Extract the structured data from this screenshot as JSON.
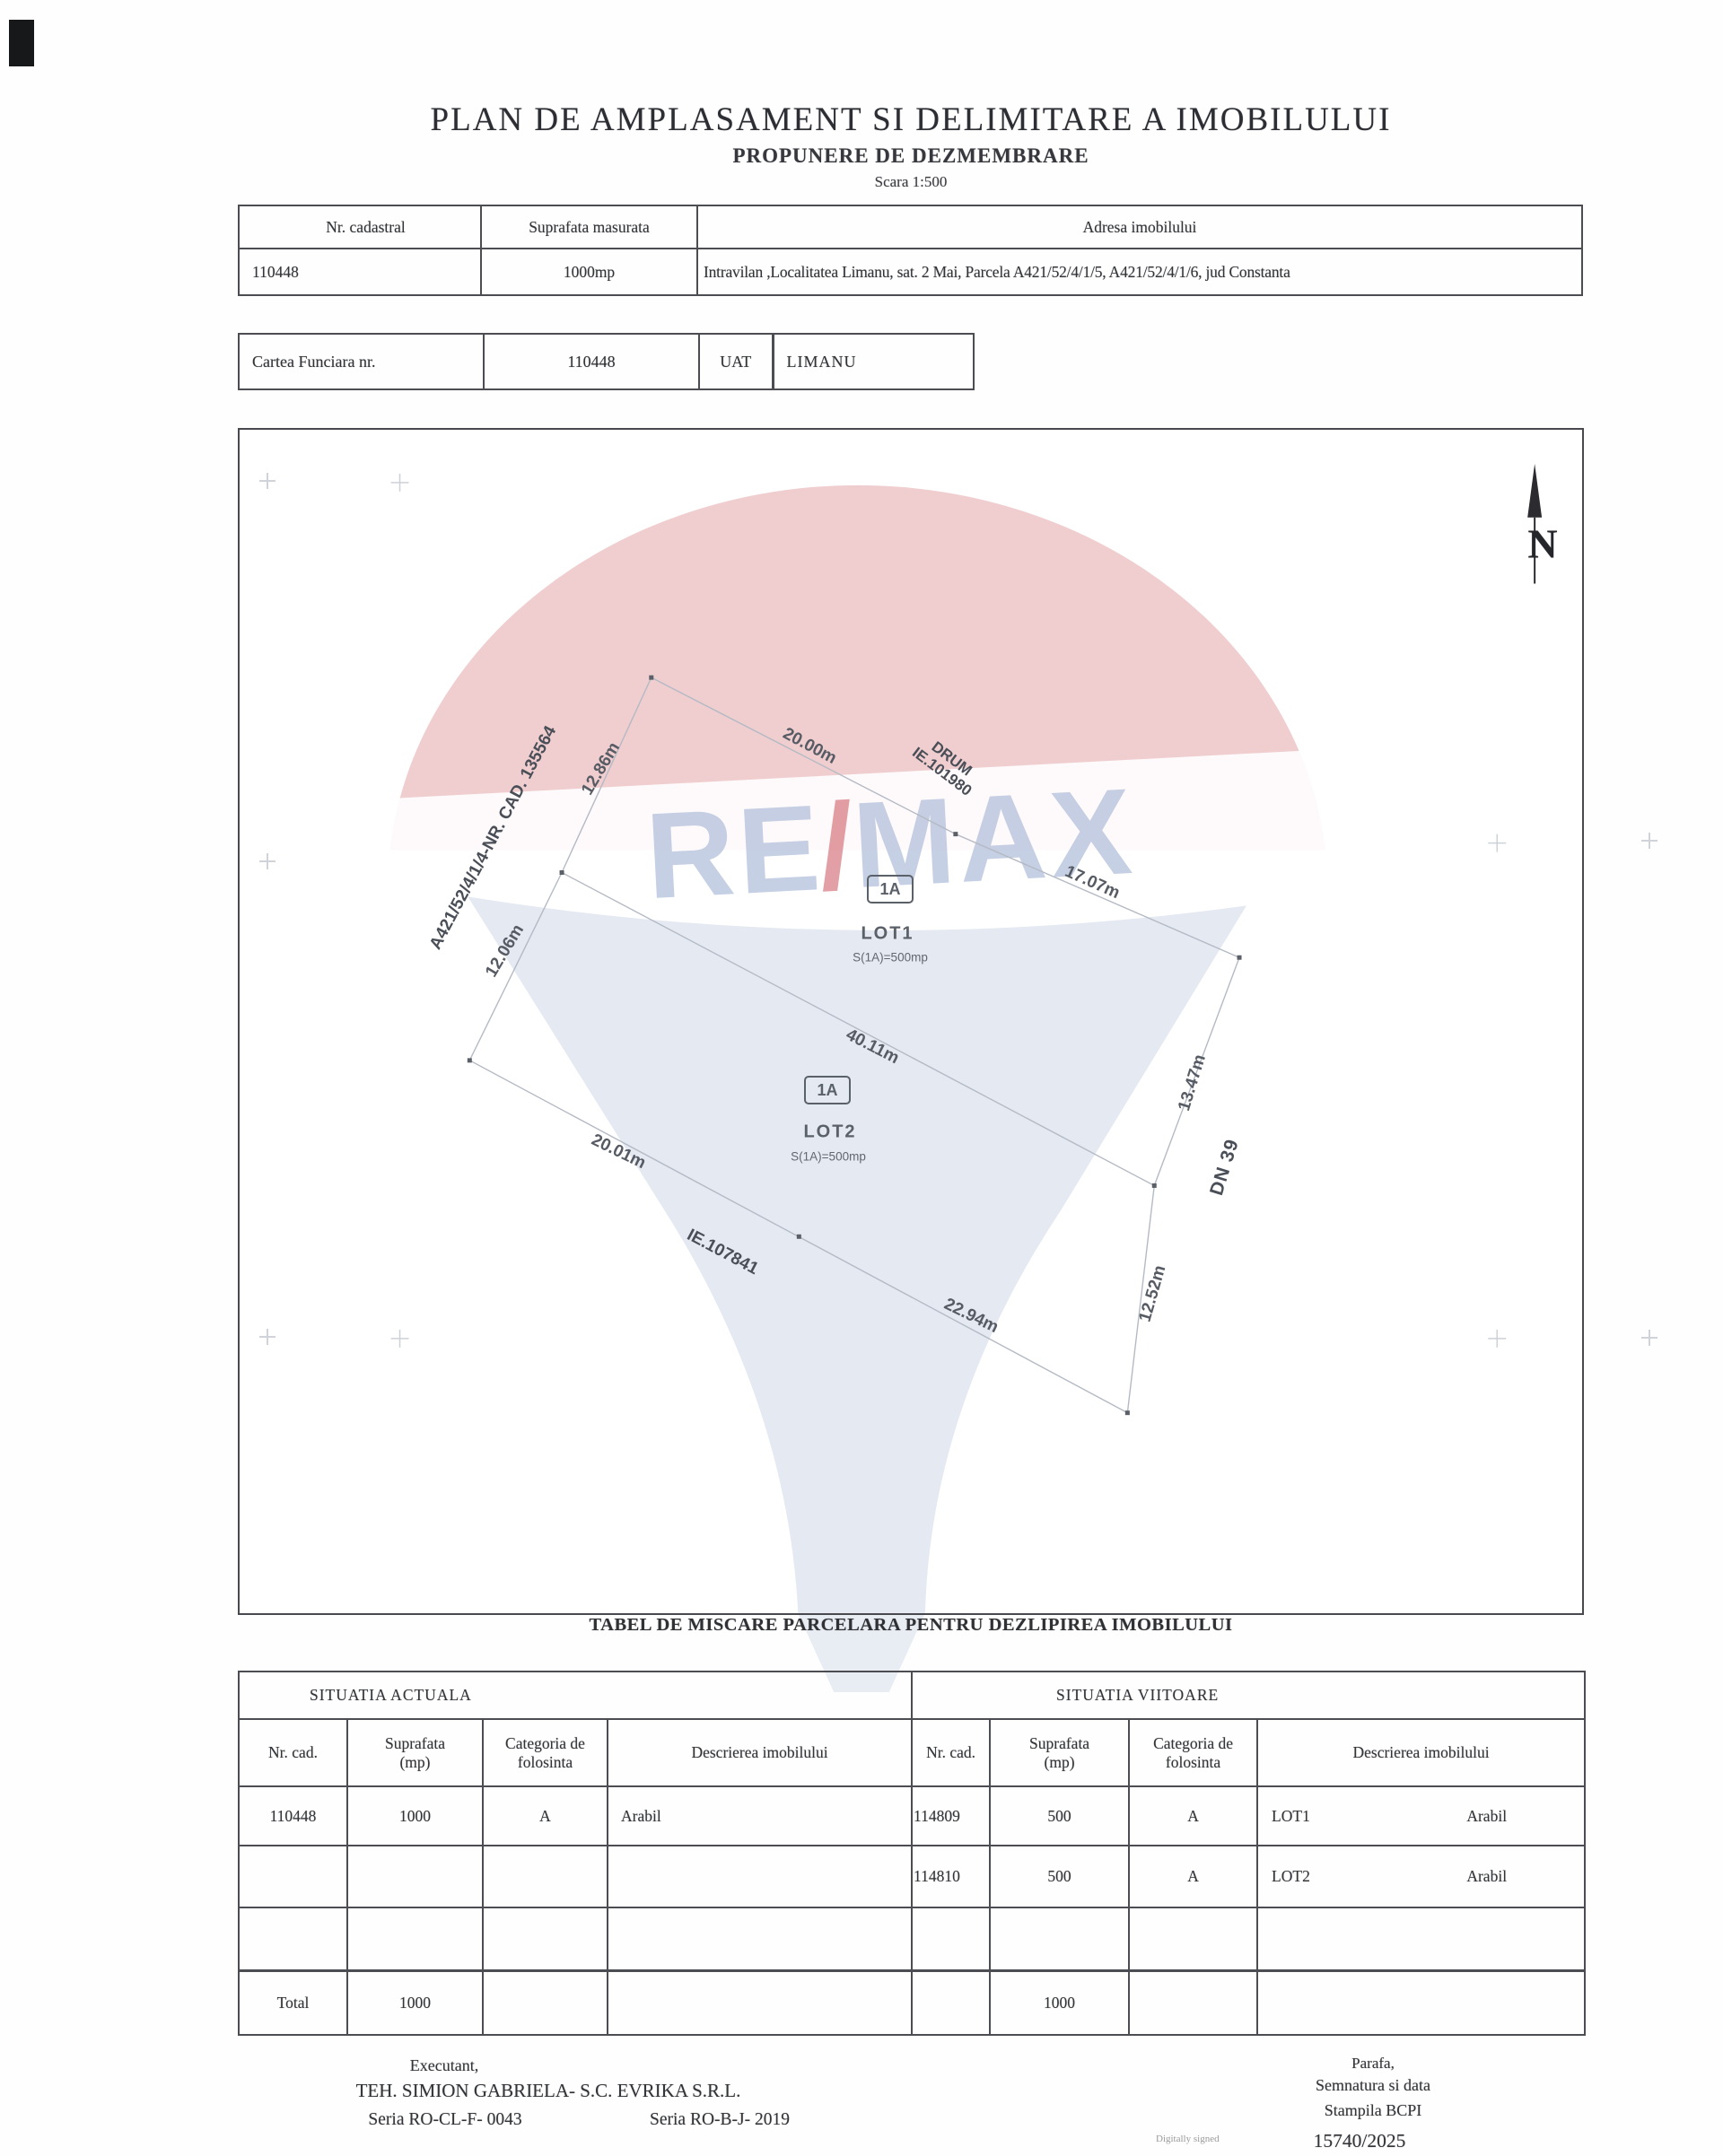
{
  "header": {
    "title": "PLAN DE AMPLASAMENT SI DELIMITARE A IMOBILULUI",
    "subtitle": "PROPUNERE DE DEZMEMBRARE",
    "scale": "Scara 1:500"
  },
  "info_table": {
    "col_cadastral": "Nr. cadastral",
    "col_suprafata": "Suprafata masurata",
    "col_adresa": "Adresa imobilului",
    "nr_cadastral": "110448",
    "suprafata": "1000mp",
    "adresa": "Intravilan ,Localitatea Limanu, sat. 2 Mai, Parcela A421/52/4/1/5, A421/52/4/1/6, jud Constanta"
  },
  "cf_table": {
    "label": "Cartea Funciara nr.",
    "numar": "110448",
    "uat_label": "UAT",
    "uat_value": "LIMANU"
  },
  "plan": {
    "north": "N",
    "watermark": {
      "re": "RE",
      "slash": "/",
      "max": "MAX",
      "red": "#c75c66",
      "blue": "#9fb1d2"
    },
    "lot1": {
      "tag": "1A",
      "name": "LOT1",
      "area": "S(1A)=500mp"
    },
    "lot2": {
      "tag": "1A",
      "name": "LOT2",
      "area": "S(1A)=500mp"
    },
    "labels": {
      "len_top": "20.00m",
      "drum1": "DRUM",
      "drum2": "IE.101980",
      "len_right_top": "17.07m",
      "parcel_left": "A421/52/4/1/4-NR. CAD. 135564",
      "len_left_upper": "12.86m",
      "len_left_lower": "12.06m",
      "len_mid": "40.11m",
      "len_bottom_left": "20.01m",
      "ie": "IE.107841",
      "len_bottom_right": "22.94m",
      "len_right_upper": "13.47m",
      "road": "DN 39",
      "len_right_lower": "12.52m"
    }
  },
  "movement": {
    "title": "TABEL DE MISCARE PARCELARA PENTRU DEZLIPIREA IMOBILULUI",
    "left_title": "SITUATIA ACTUALA",
    "right_title": "SITUATIA VIITOARE",
    "cols": {
      "nr": "Nr. cad.",
      "suprafata": "Suprafata (mp)",
      "categoria": "Categoria de folosinta",
      "descriere": "Descrierea imobilului"
    },
    "rows": [
      {
        "old_cad": "110448",
        "old_area": "1000",
        "old_cat": "A",
        "old_desc": "Arabil",
        "new_cad": "114809",
        "new_area": "500",
        "new_cat": "A",
        "new_lot": "LOT1",
        "new_desc": "Arabil"
      },
      {
        "old_cad": "",
        "old_area": "",
        "old_cat": "",
        "old_desc": "",
        "new_cad": "114810",
        "new_area": "500",
        "new_cat": "A",
        "new_lot": "LOT2",
        "new_desc": "Arabil"
      },
      {
        "old_cad": "",
        "old_area": "",
        "old_cat": "",
        "old_desc": "",
        "new_cad": "",
        "new_area": "",
        "new_cat": "",
        "new_lot": "",
        "new_desc": ""
      }
    ],
    "total": {
      "label": "Total",
      "old_area": "1000",
      "new_area": "1000"
    }
  },
  "footer": {
    "executant_label": "Executant,",
    "executant_name": "TEH. SIMION GABRIELA- S.C. EVRIKA S.R.L.",
    "seria1": "Seria RO-CL-F- 0043",
    "seria2": "Seria RO-B-J- 2019",
    "parafa": "Parafa,",
    "semnatura": "Semnatura si data",
    "stampila": "Stampila BCPI",
    "digital": "Digitally signed",
    "numar": "15740/2025"
  }
}
